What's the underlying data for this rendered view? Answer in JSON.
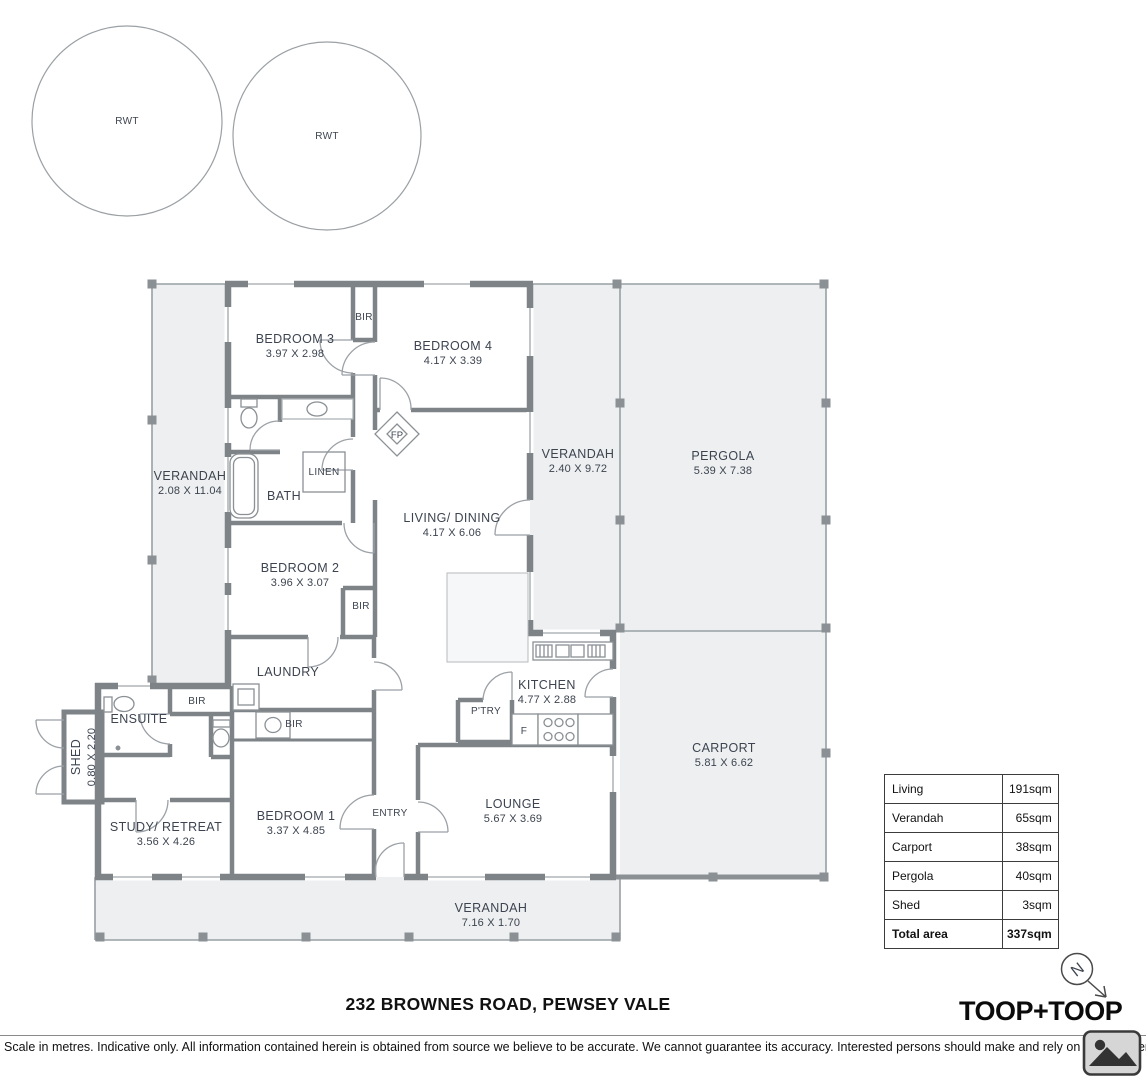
{
  "colors": {
    "wall": "#7e8387",
    "outdoor_fill": "#edeff0",
    "label_text": "#3d4450",
    "table_border": "#3c3c3c"
  },
  "tanks": {
    "tank1": "RWT",
    "tank2": "RWT"
  },
  "rooms": {
    "verandah_left": {
      "name": "VERANDAH",
      "dims": "2.08 X 11.04"
    },
    "bedroom3": {
      "name": "BEDROOM 3",
      "dims": "3.97 X 2.98"
    },
    "bir_bed3": {
      "name": "BIR"
    },
    "bedroom4": {
      "name": "BEDROOM 4",
      "dims": "4.17 X 3.39"
    },
    "verandah_mid": {
      "name": "VERANDAH",
      "dims": "2.40 X 9.72"
    },
    "pergola": {
      "name": "PERGOLA",
      "dims": "5.39 X 7.38"
    },
    "bath": {
      "name": "BATH"
    },
    "linen": {
      "name": "LINEN"
    },
    "fireplace": {
      "name": "FP"
    },
    "living_dining": {
      "name": "LIVING/ DINING",
      "dims": "4.17 X 6.06"
    },
    "bedroom2": {
      "name": "BEDROOM 2",
      "dims": "3.96 X 3.07"
    },
    "bir_bed2": {
      "name": "BIR"
    },
    "laundry": {
      "name": "LAUNDRY"
    },
    "kitchen": {
      "name": "KITCHEN",
      "dims": "4.77 X 2.88"
    },
    "pantry": {
      "name": "P'TRY"
    },
    "fridge": {
      "name": "F"
    },
    "ensuite": {
      "name": "ENSUITE"
    },
    "bir_hall": {
      "name": "BIR"
    },
    "shed": {
      "name": "SHED",
      "dims": "0.80 X 2.20"
    },
    "study": {
      "name": "STUDY/ RETREAT",
      "dims": "3.56 X 4.26"
    },
    "bedroom1": {
      "name": "BEDROOM 1",
      "dims": "3.37 X 4.85"
    },
    "bir_bed1": {
      "name": "BIR"
    },
    "entry": {
      "name": "ENTRY"
    },
    "lounge": {
      "name": "LOUNGE",
      "dims": "5.67 X 3.69"
    },
    "carport": {
      "name": "CARPORT",
      "dims": "5.81 X 6.62"
    },
    "verandah_bottom": {
      "name": "VERANDAH",
      "dims": "7.16 X 1.70"
    }
  },
  "area_table": {
    "rows": [
      {
        "label": "Living",
        "value": "191sqm"
      },
      {
        "label": "Verandah",
        "value": "65sqm"
      },
      {
        "label": "Carport",
        "value": "38sqm"
      },
      {
        "label": "Pergola",
        "value": "40sqm"
      },
      {
        "label": "Shed",
        "value": "3sqm"
      }
    ],
    "total_label": "Total area",
    "total_value": "337sqm"
  },
  "footer": {
    "address": "232 BROWNES ROAD, PEWSEY VALE",
    "disclaimer": "Scale in metres. Indicative only. All information contained herein is obtained from source we believe to be accurate. We cannot guarantee its accuracy. Interested persons should make and rely on their own enq",
    "logo_text": "TOOP+TOOP",
    "compass_letter": "N"
  }
}
